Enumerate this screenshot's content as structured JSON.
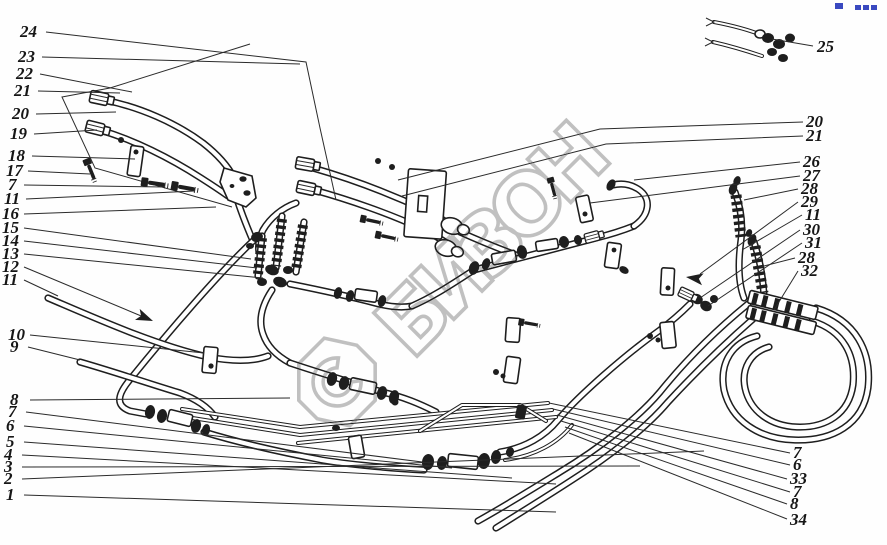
{
  "page": {
    "width": 887,
    "height": 545,
    "kind": "exploded-parts-diagram"
  },
  "colors": {
    "ink": "#1e1e1e",
    "paper": "#fefefe",
    "watermark": "#bdbdbd",
    "blue_mark": "#3a49c0"
  },
  "watermark": {
    "text": "БИЗОН",
    "logo_letter": "С"
  },
  "arrows": [
    {
      "x": 153,
      "y": 321,
      "deg": 23
    },
    {
      "x": 686,
      "y": 277,
      "deg": 188
    }
  ],
  "callouts": [
    {
      "t": "24",
      "x": 20,
      "y": 37,
      "pts": [
        [
          46,
          32
        ],
        [
          306,
          62
        ],
        [
          320,
          128
        ],
        [
          336,
          200
        ]
      ]
    },
    {
      "t": "23",
      "x": 18,
      "y": 62,
      "pts": [
        [
          42,
          57
        ],
        [
          300,
          64
        ]
      ]
    },
    {
      "t": "22",
      "x": 16,
      "y": 79,
      "pts": [
        [
          40,
          74
        ],
        [
          132,
          92
        ]
      ]
    },
    {
      "t": "21",
      "x": 14,
      "y": 96,
      "pts": [
        [
          38,
          91
        ],
        [
          120,
          93
        ]
      ]
    },
    {
      "t": "20",
      "x": 12,
      "y": 119,
      "pts": [
        [
          36,
          114
        ],
        [
          116,
          112
        ]
      ]
    },
    {
      "t": "19",
      "x": 10,
      "y": 139,
      "pts": [
        [
          34,
          134
        ],
        [
          97,
          130
        ]
      ]
    },
    {
      "t": "18",
      "x": 8,
      "y": 161,
      "pts": [
        [
          32,
          156
        ],
        [
          135,
          159
        ]
      ]
    },
    {
      "t": "17",
      "x": 6,
      "y": 176,
      "pts": [
        [
          28,
          171
        ],
        [
          90,
          174
        ]
      ]
    },
    {
      "t": "7",
      "x": 8,
      "y": 190,
      "pts": [
        [
          24,
          185
        ],
        [
          165,
          187
        ]
      ]
    },
    {
      "t": "11",
      "x": 4,
      "y": 204,
      "pts": [
        [
          26,
          199
        ],
        [
          194,
          191
        ]
      ]
    },
    {
      "t": "16",
      "x": 2,
      "y": 219,
      "pts": [
        [
          24,
          214
        ],
        [
          216,
          207
        ]
      ]
    },
    {
      "t": "15",
      "x": 2,
      "y": 233,
      "pts": [
        [
          24,
          228
        ],
        [
          251,
          259
        ]
      ]
    },
    {
      "t": "14",
      "x": 2,
      "y": 246,
      "pts": [
        [
          24,
          241
        ],
        [
          257,
          268
        ]
      ]
    },
    {
      "t": "13",
      "x": 2,
      "y": 259,
      "pts": [
        [
          24,
          254
        ],
        [
          263,
          278
        ]
      ]
    },
    {
      "t": "12",
      "x": 2,
      "y": 272,
      "pts": [
        [
          24,
          267
        ],
        [
          146,
          318
        ]
      ]
    },
    {
      "t": "11",
      "x": 2,
      "y": 285,
      "pts": [
        [
          24,
          280
        ],
        [
          58,
          296
        ]
      ]
    },
    {
      "t": "10",
      "x": 8,
      "y": 340,
      "pts": [
        [
          30,
          335
        ],
        [
          204,
          353
        ]
      ]
    },
    {
      "t": "9",
      "x": 10,
      "y": 352,
      "pts": [
        [
          28,
          347
        ],
        [
          80,
          360
        ]
      ]
    },
    {
      "t": "8",
      "x": 10,
      "y": 405,
      "pts": [
        [
          30,
          400
        ],
        [
          290,
          398
        ]
      ]
    },
    {
      "t": "7",
      "x": 8,
      "y": 417,
      "pts": [
        [
          26,
          412
        ],
        [
          430,
          463
        ]
      ]
    },
    {
      "t": "6",
      "x": 6,
      "y": 431,
      "pts": [
        [
          24,
          426
        ],
        [
          452,
          468
        ]
      ]
    },
    {
      "t": "5",
      "x": 6,
      "y": 447,
      "pts": [
        [
          24,
          442
        ],
        [
          512,
          478
        ]
      ]
    },
    {
      "t": "4",
      "x": 4,
      "y": 460,
      "pts": [
        [
          22,
          455
        ],
        [
          556,
          484
        ]
      ]
    },
    {
      "t": "3",
      "x": 4,
      "y": 472,
      "pts": [
        [
          22,
          467
        ],
        [
          640,
          466
        ]
      ]
    },
    {
      "t": "2",
      "x": 4,
      "y": 484,
      "pts": [
        [
          22,
          479
        ],
        [
          704,
          451
        ]
      ]
    },
    {
      "t": "1",
      "x": 6,
      "y": 500,
      "pts": [
        [
          24,
          495
        ],
        [
          556,
          512
        ]
      ]
    },
    {
      "t": "20",
      "x": 806,
      "y": 127,
      "pts": [
        [
          803,
          122
        ],
        [
          600,
          129
        ],
        [
          398,
          180
        ]
      ]
    },
    {
      "t": "21",
      "x": 806,
      "y": 141,
      "pts": [
        [
          803,
          136
        ],
        [
          606,
          144
        ],
        [
          402,
          196
        ]
      ]
    },
    {
      "t": "26",
      "x": 803,
      "y": 167,
      "pts": [
        [
          800,
          162
        ],
        [
          634,
          180
        ]
      ]
    },
    {
      "t": "27",
      "x": 803,
      "y": 181,
      "pts": [
        [
          800,
          176
        ],
        [
          590,
          203
        ]
      ]
    },
    {
      "t": "28",
      "x": 801,
      "y": 194,
      "pts": [
        [
          798,
          189
        ],
        [
          744,
          200
        ]
      ]
    },
    {
      "t": "29",
      "x": 801,
      "y": 207,
      "pts": [
        [
          798,
          202
        ],
        [
          700,
          274
        ]
      ]
    },
    {
      "t": "11",
      "x": 805,
      "y": 220,
      "pts": [
        [
          802,
          215
        ],
        [
          742,
          250
        ]
      ]
    },
    {
      "t": "30",
      "x": 803,
      "y": 235,
      "pts": [
        [
          800,
          230
        ],
        [
          700,
          298
        ]
      ]
    },
    {
      "t": "31",
      "x": 805,
      "y": 248,
      "pts": [
        [
          802,
          243
        ],
        [
          708,
          306
        ]
      ]
    },
    {
      "t": "28",
      "x": 798,
      "y": 263,
      "pts": [
        [
          795,
          258
        ],
        [
          760,
          267
        ]
      ]
    },
    {
      "t": "32",
      "x": 801,
      "y": 276,
      "pts": [
        [
          798,
          271
        ],
        [
          774,
          310
        ]
      ]
    },
    {
      "t": "7",
      "x": 793,
      "y": 458,
      "pts": [
        [
          790,
          453
        ],
        [
          549,
          403
        ]
      ]
    },
    {
      "t": "6",
      "x": 793,
      "y": 470,
      "pts": [
        [
          790,
          465
        ],
        [
          553,
          409
        ]
      ]
    },
    {
      "t": "33",
      "x": 790,
      "y": 484,
      "pts": [
        [
          787,
          479
        ],
        [
          557,
          415
        ]
      ]
    },
    {
      "t": "7",
      "x": 793,
      "y": 497,
      "pts": [
        [
          790,
          492
        ],
        [
          561,
          421
        ]
      ]
    },
    {
      "t": "8",
      "x": 790,
      "y": 509,
      "pts": [
        [
          787,
          504
        ],
        [
          565,
          427
        ]
      ]
    },
    {
      "t": "34",
      "x": 790,
      "y": 525,
      "pts": [
        [
          787,
          519
        ],
        [
          569,
          433
        ]
      ]
    },
    {
      "t": "25",
      "x": 817,
      "y": 52,
      "pts": [
        [
          813,
          46
        ],
        [
          772,
          39
        ]
      ]
    }
  ]
}
